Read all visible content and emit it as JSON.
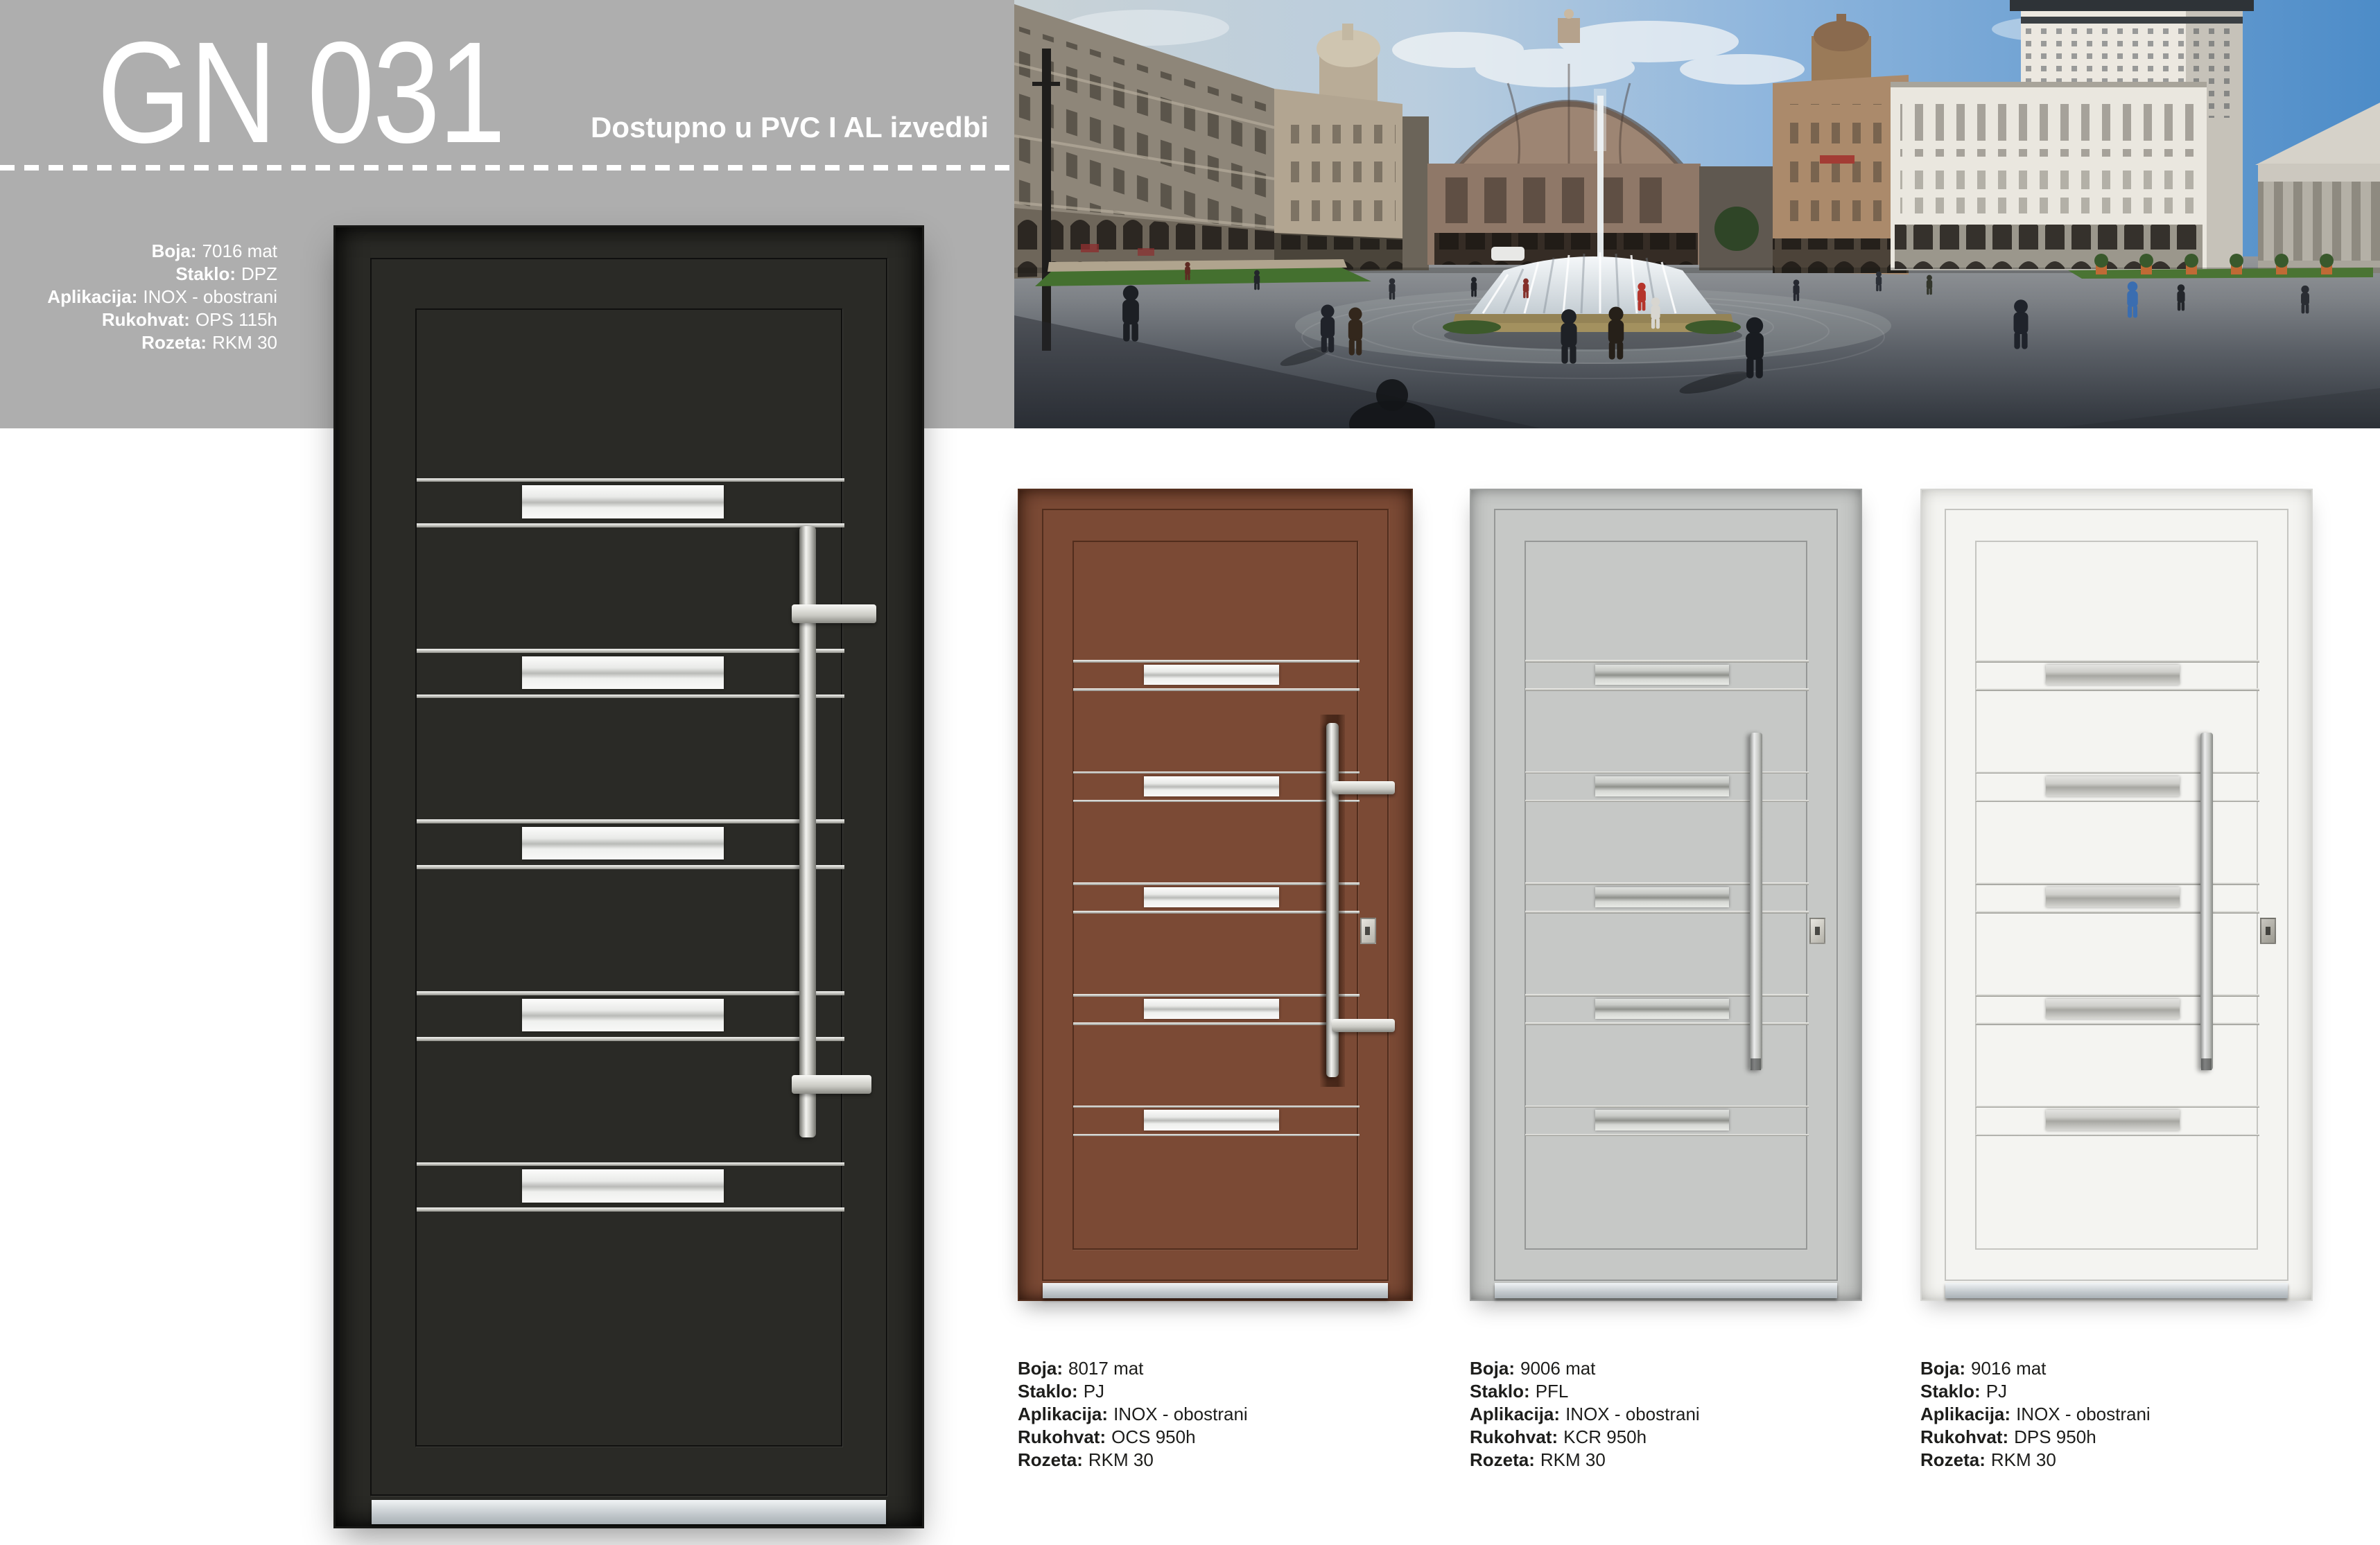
{
  "page": {
    "code": "GN 031",
    "availability": "Dostupno u PVC I AL izvedbi"
  },
  "main_door": {
    "color_code": "7016 mat",
    "specs": [
      {
        "label": "Boja:",
        "value": "7016 mat"
      },
      {
        "label": "Staklo:",
        "value": "DPZ"
      },
      {
        "label": "Aplikacija:",
        "value": "INOX - obostrani"
      },
      {
        "label": "Rukohvat:",
        "value": "OPS 115h"
      },
      {
        "label": "Rozeta:",
        "value": "RKM 30"
      }
    ]
  },
  "variants": [
    {
      "color_code": "8017 mat",
      "specs": [
        {
          "label": "Boja:",
          "value": "8017 mat"
        },
        {
          "label": "Staklo:",
          "value": "PJ"
        },
        {
          "label": "Aplikacija:",
          "value": "INOX - obostrani"
        },
        {
          "label": "Rukohvat:",
          "value": "OCS 950h"
        },
        {
          "label": "Rozeta:",
          "value": "RKM 30"
        }
      ]
    },
    {
      "color_code": "9006 mat",
      "specs": [
        {
          "label": "Boja:",
          "value": "9006 mat"
        },
        {
          "label": "Staklo:",
          "value": "PFL"
        },
        {
          "label": "Aplikacija:",
          "value": "INOX - obostrani"
        },
        {
          "label": "Rukohvat:",
          "value": "KCR 950h"
        },
        {
          "label": "Rozeta:",
          "value": "RKM 30"
        }
      ]
    },
    {
      "color_code": "9016 mat",
      "specs": [
        {
          "label": "Boja:",
          "value": "9016 mat"
        },
        {
          "label": "Staklo:",
          "value": "PJ"
        },
        {
          "label": "Aplikacija:",
          "value": "INOX - obostrani"
        },
        {
          "label": "Rukohvat:",
          "value": "DPS 950h"
        },
        {
          "label": "Rozeta:",
          "value": "RKM 30"
        }
      ]
    }
  ],
  "colors": {
    "header_gray": "#aeaeae",
    "door_7016": "#2a2a26",
    "door_8017": "#7b4a35",
    "door_9006": "#c6c8c6",
    "door_9016": "#f4f4f1",
    "inox": "#d9d9d4",
    "spec_text": "#1d1d1b"
  }
}
